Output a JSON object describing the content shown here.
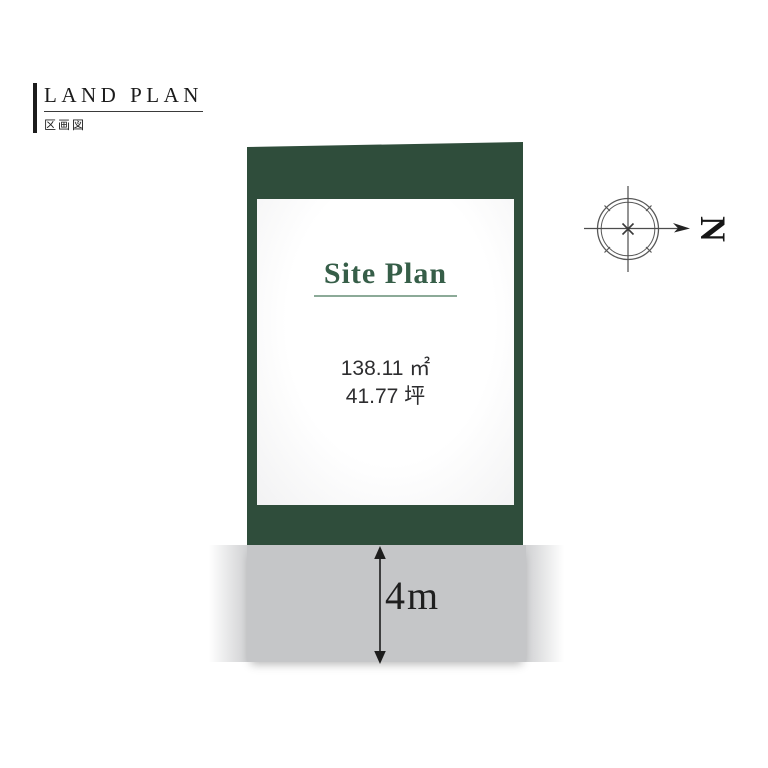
{
  "header": {
    "title": "LAND PLAN",
    "subtitle": "区画図"
  },
  "plot": {
    "label": "Site Plan",
    "area_sqm": "138.11 ㎡",
    "area_tsubo": "41.77 坪"
  },
  "road": {
    "width_label": "4m"
  },
  "compass": {
    "north_label": "N"
  },
  "colors": {
    "plot_green": "#2f4d3b",
    "accent_green": "#365e48",
    "underline_green": "#8caa98",
    "road_gray": "#c5c6c8",
    "ink": "#1c1c1c"
  }
}
